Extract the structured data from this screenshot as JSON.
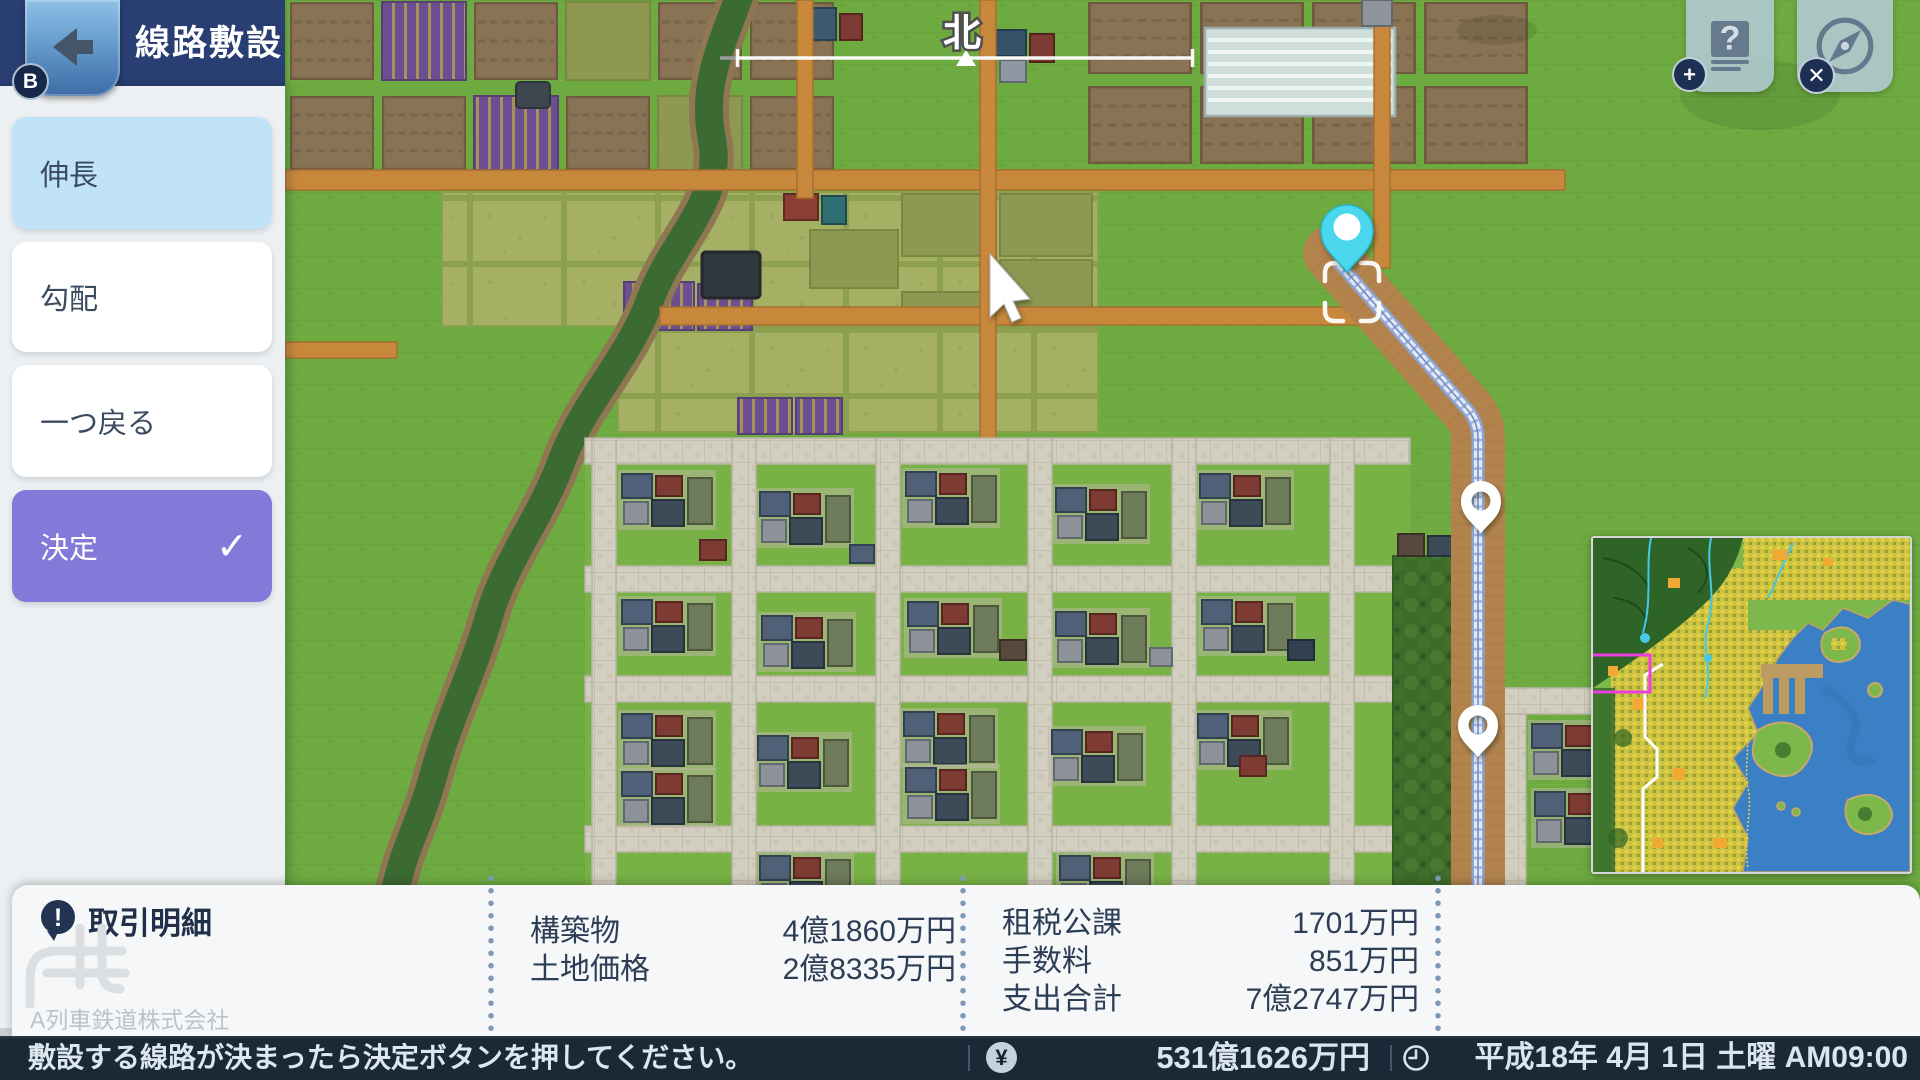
{
  "header": {
    "title": "線路敷設",
    "back_badge_label": "B"
  },
  "sidebar": {
    "buttons": [
      {
        "label": "伸長",
        "state": "selected"
      },
      {
        "label": "勾配",
        "state": "normal"
      },
      {
        "label": "一つ戻る",
        "state": "normal"
      },
      {
        "label": "決定",
        "state": "primary"
      }
    ],
    "decide_check_glyph": "✓"
  },
  "map": {
    "north_label": "北"
  },
  "top_right": {
    "help_glyph": "?",
    "plus_badge": "+",
    "close_badge": "✕"
  },
  "transaction_panel": {
    "title": "取引明細",
    "alert_glyph": "!",
    "company_watermark": "A列車鉄道株式会社",
    "columns": [
      {
        "rows": [
          {
            "label": "構築物",
            "value": "4億1860万円"
          },
          {
            "label": "土地価格",
            "value": "2億8335万円"
          }
        ]
      },
      {
        "rows": [
          {
            "label": "租税公課",
            "value": "1701万円"
          },
          {
            "label": "手数料",
            "value": "851万円"
          },
          {
            "label": "支出合計",
            "value": "7億2747万円"
          }
        ]
      }
    ]
  },
  "status_bar": {
    "instruction": "敷設する線路が決まったら決定ボタンを押してください。",
    "currency_glyph": "¥",
    "funds": "531億1626万円",
    "datetime": "平成18年 4月 1日  土曜  AM09:00"
  },
  "colors": {
    "header_navy": "#293e72",
    "selected_blue": "#c0e3f8",
    "primary_purple": "#8478d8",
    "status_navy": "#1b2836",
    "pin_cyan": "#4cd7ee",
    "road_orange": "#c8883c"
  }
}
